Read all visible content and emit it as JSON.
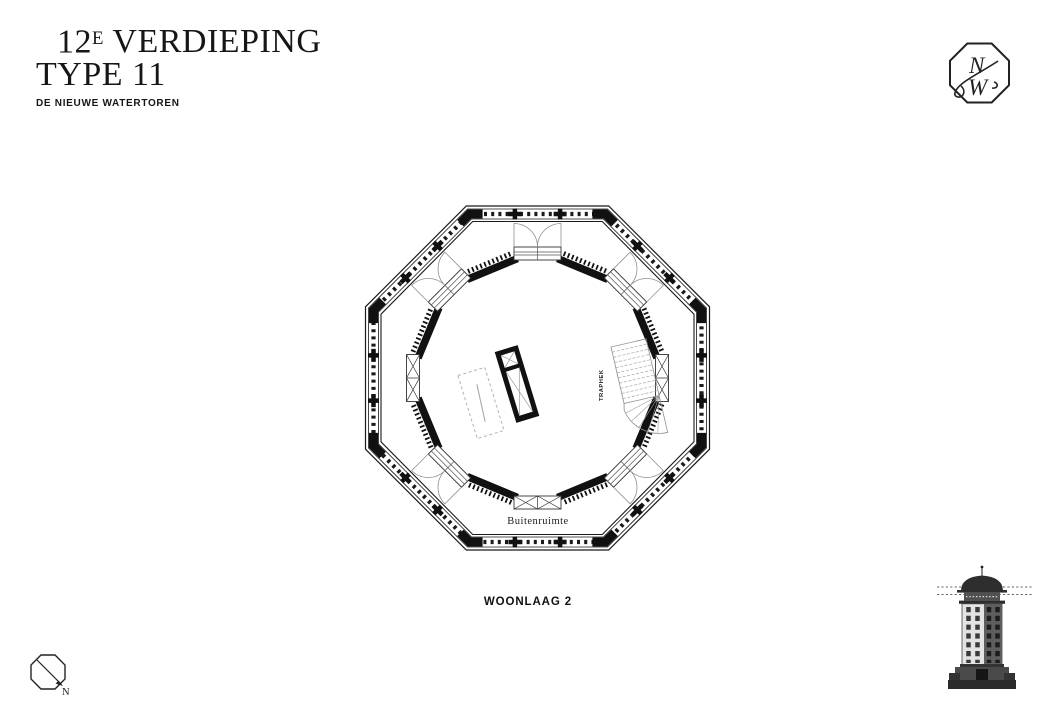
{
  "title": {
    "floor_number": "12",
    "floor_ordinal_suffix": "E",
    "line1_rest": "VERDIEPING",
    "line2": "TYPE 11",
    "subtitle": "DE NIEUWE WATERTOREN"
  },
  "logo": {
    "letter_n": "N",
    "letter_w": "W"
  },
  "plan": {
    "stair_label": "TRAPHEK",
    "terrace_label": "Buitenruimte",
    "caption": "WOONLAAG 2"
  },
  "compass": {
    "north_label": "N"
  },
  "colors": {
    "ink": "#161616",
    "wall_black": "#111111",
    "detail_gray": "#8f8f8f",
    "dashed_gray": "#b3b3b3",
    "background": "#ffffff"
  }
}
